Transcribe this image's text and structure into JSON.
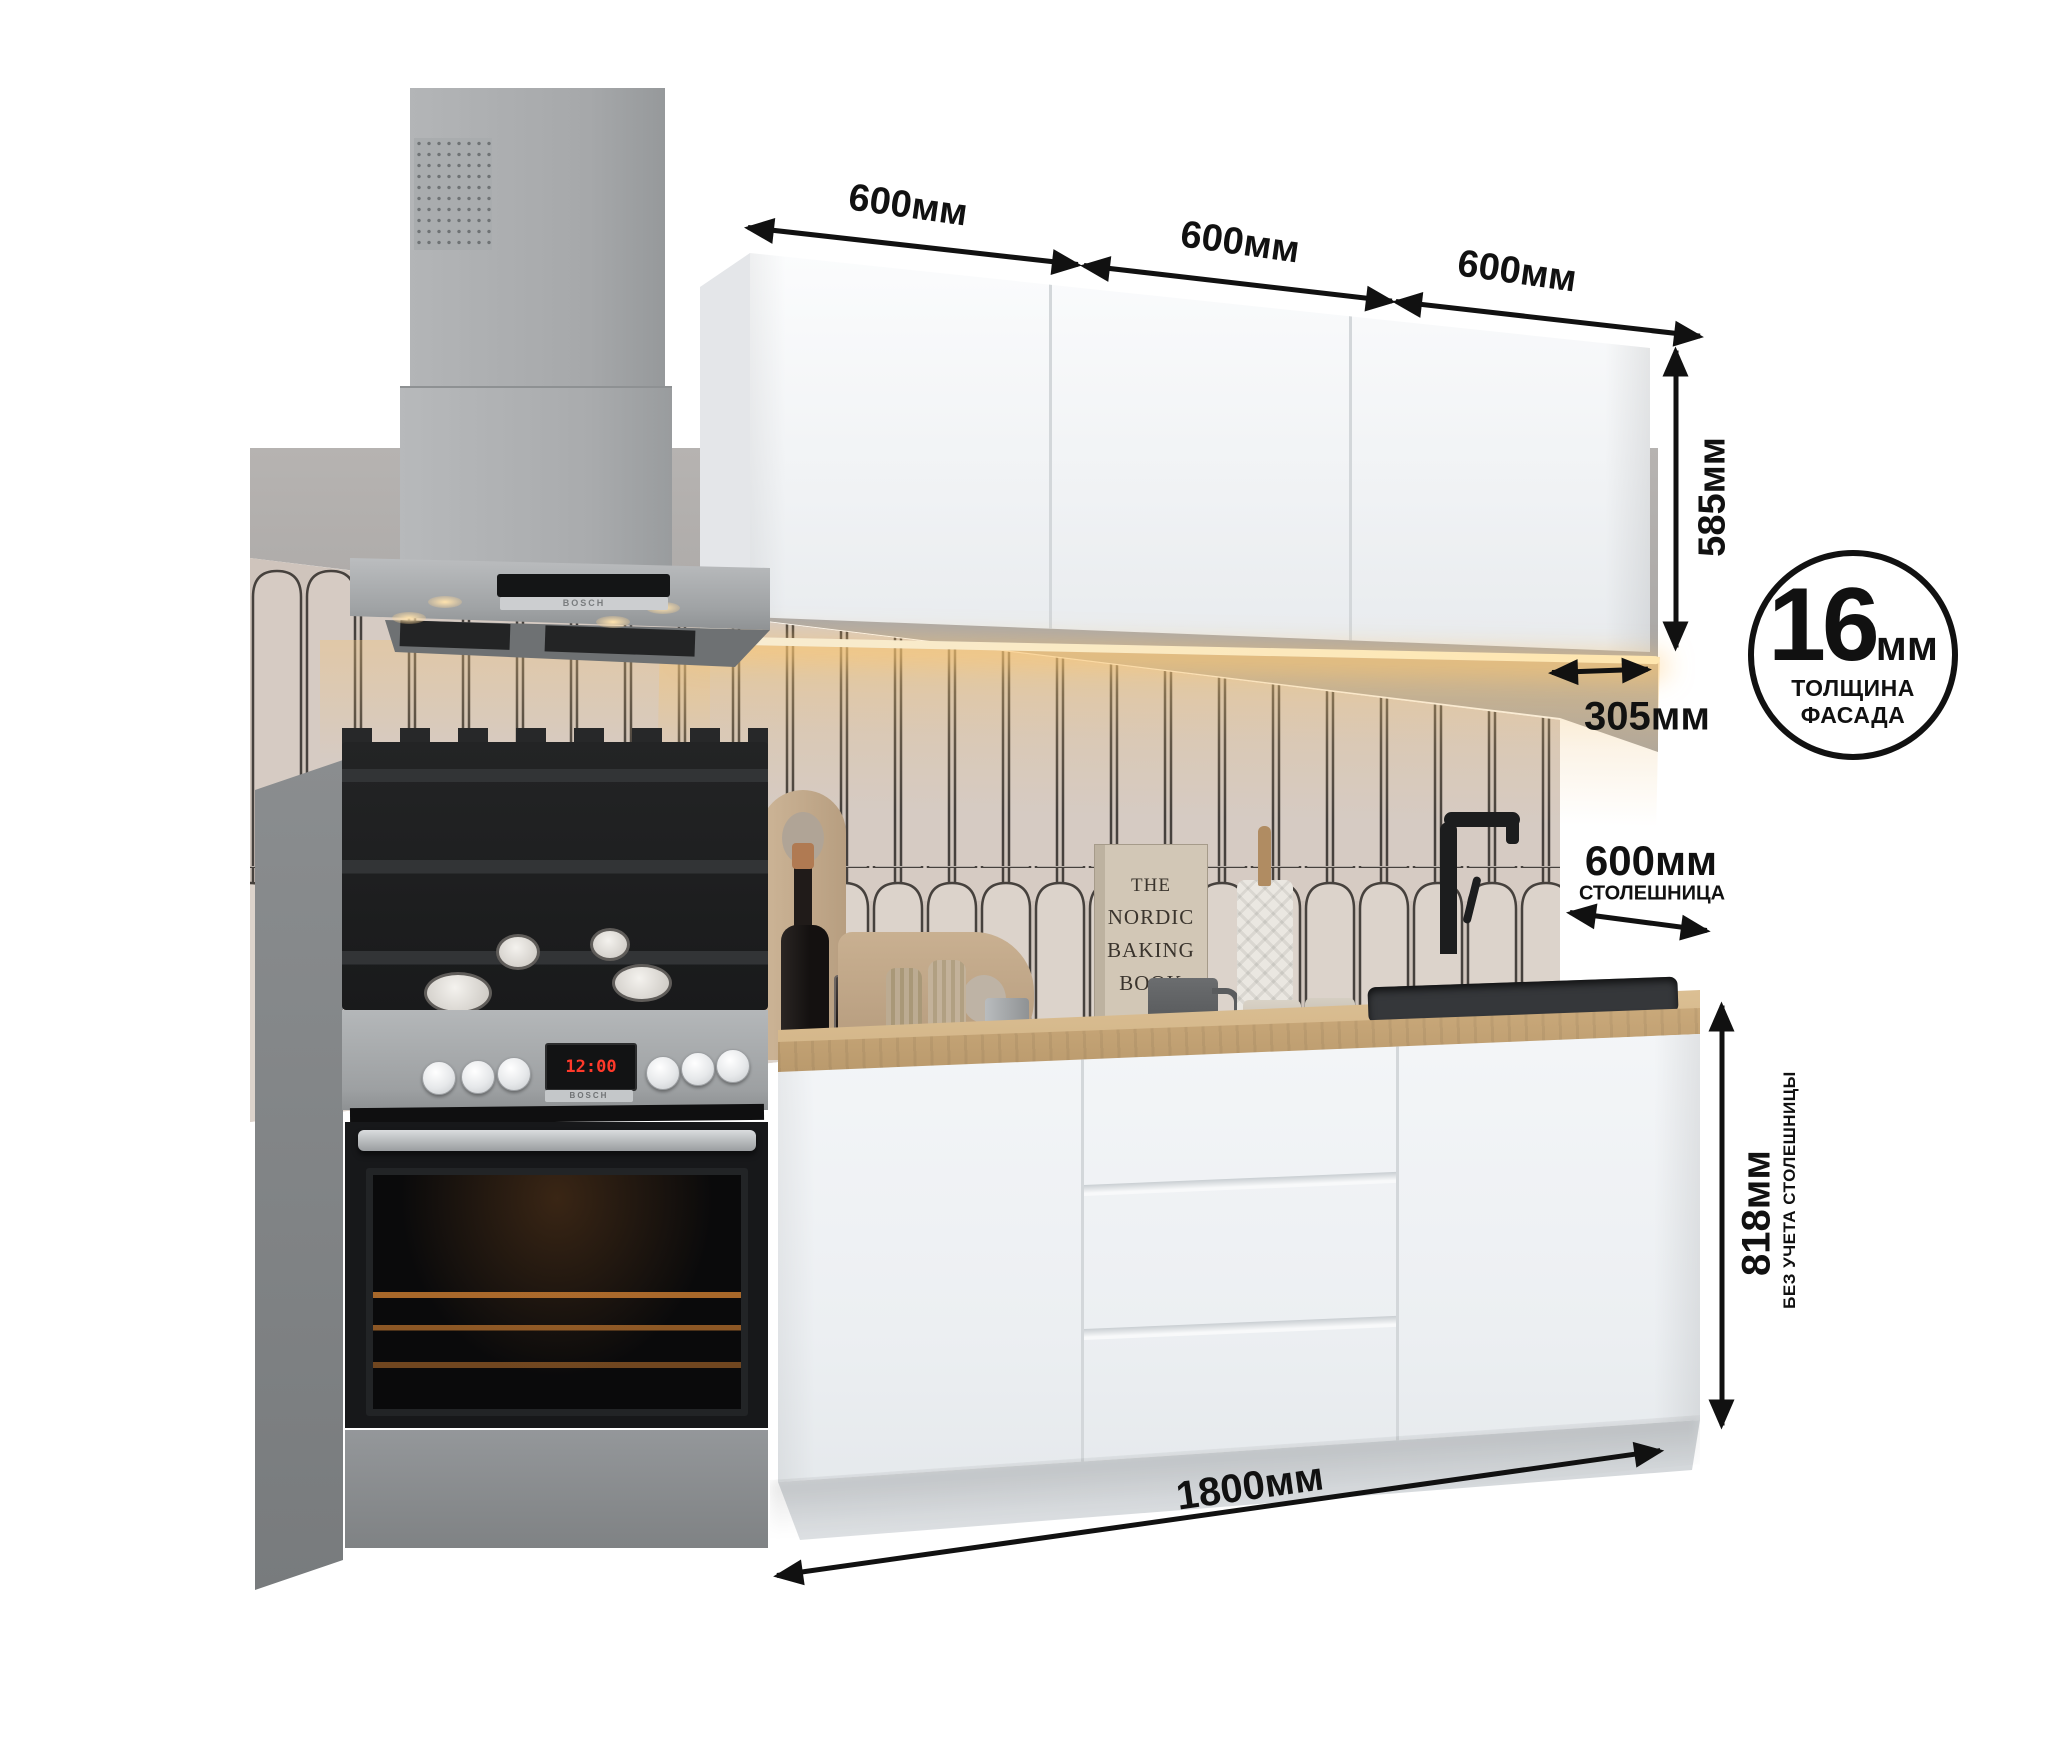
{
  "image_type": "kitchen set product render with dimension callouts",
  "dimensions": {
    "top_widths": [
      "600мм",
      "600мм",
      "600мм"
    ],
    "upper_height": "585мм",
    "upper_depth": "305мм",
    "facade_badge": {
      "value": "16",
      "unit": "мм",
      "caption_line1": "ТОЛЩИНА",
      "caption_line2": "ФАСАДА"
    },
    "countertop": {
      "value": "600мм",
      "caption": "СТОЛЕШНИЦА"
    },
    "base_height": {
      "value": "818мм",
      "caption": "БЕЗ УЧЕТА СТОЛЕШНИЦЫ"
    },
    "total_width": "1800мм"
  },
  "appliances": {
    "stove": {
      "brand": "BOSCH",
      "display": "12:00"
    },
    "hood": {
      "brand": "BOSCH"
    }
  },
  "decor": {
    "book_upright": {
      "line1": "THE",
      "line2": "NORDIC",
      "line3": "BAKING",
      "line4": "BOOK"
    },
    "book_flat": "BREW"
  },
  "colors": {
    "dimension_ink": "#111111",
    "cabinet_white": "#f2f4f6",
    "countertop_wood": "#c7a377",
    "wall_grey": "#a7a4a2",
    "tile_beige": "#d6cbc3",
    "steel": "#a6a9ab",
    "led_warm": "#ffd9a0"
  }
}
